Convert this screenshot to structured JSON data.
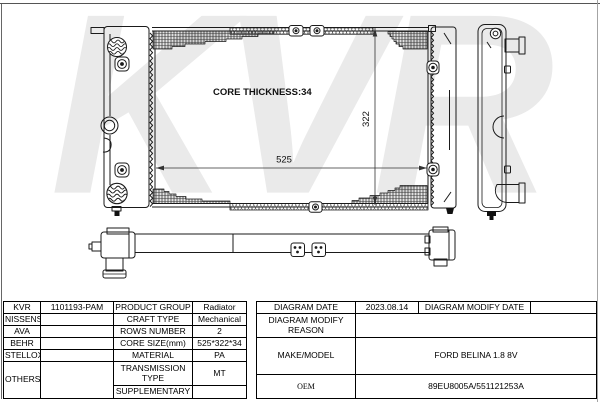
{
  "watermark": "KVR",
  "colors": {
    "line": "#1a1a1a",
    "watermark": "#eaeaea",
    "frame": "#9a9a9a"
  },
  "diagram": {
    "core_thickness_label": "CORE THICKNESS:34",
    "width_dim": "525",
    "height_dim": "322"
  },
  "table": {
    "left": {
      "rows": [
        {
          "brand": "KVR",
          "part": "1101193-PAM",
          "label": "PRODUCT GROUP",
          "value": "Radiator"
        },
        {
          "brand": "NISSENS",
          "part": "",
          "label": "CRAFT TYPE",
          "value": "Mechanical"
        },
        {
          "brand": "AVA",
          "part": "",
          "label": "ROWS NUMBER",
          "value": "2"
        },
        {
          "brand": "BEHR",
          "part": "",
          "label": "CORE SIZE(mm)",
          "value": "525*322*34"
        },
        {
          "brand": "STELLOX",
          "part": "",
          "label": "MATERIAL",
          "value": "PA"
        },
        {
          "brand": "OTHERS",
          "part": "",
          "label": "TRANSMISSION TYPE",
          "value": "MT"
        },
        {
          "label": "SUPPLEMENTARY",
          "value": ""
        }
      ]
    },
    "right": {
      "diagram_date_label": "DIAGRAM DATE",
      "diagram_date": "2023.08.14",
      "diagram_modify_date_label": "DIAGRAM MODIFY DATE",
      "diagram_modify_date": "",
      "diagram_modify_reason_label": "DIAGRAM MODIFY REASON",
      "diagram_modify_reason": "",
      "make_model_label": "MAKE/MODEL",
      "make_model": "FORD BELINA 1.8 8V",
      "oem_label": "OEM",
      "oem": "89EU8005A/551121253A"
    }
  }
}
